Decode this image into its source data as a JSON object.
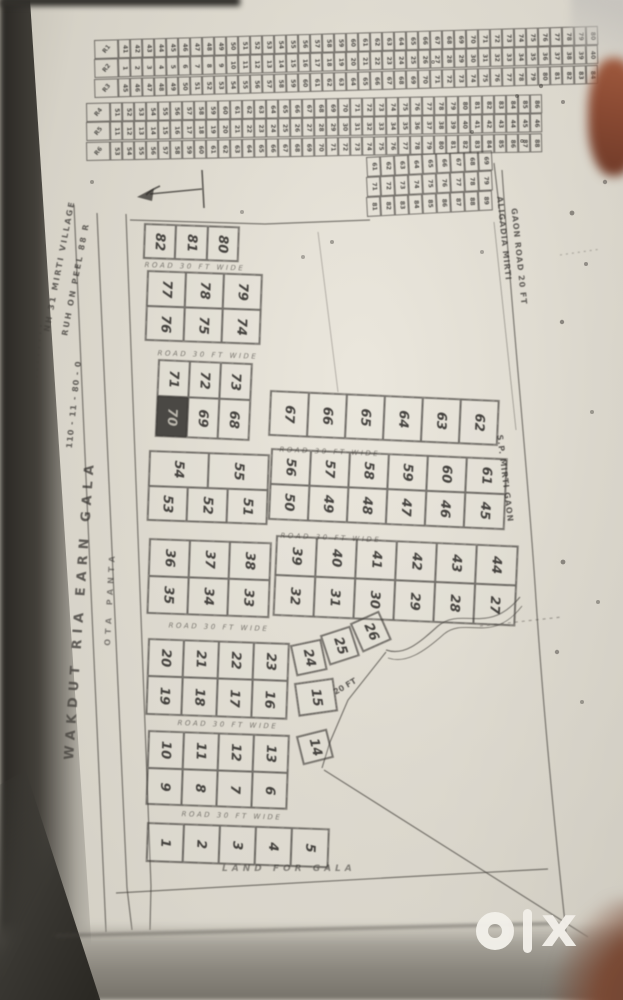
{
  "scene": {
    "description": "Photographed photocopy of a hand-drawn land plot layout / site plan, OLX listing image",
    "watermark": "olx"
  },
  "colors": {
    "paper": "#ddd9ce",
    "ink": "#3a3835",
    "shaded_plot": "#4a4844",
    "photo_edge_shadow": "#292723",
    "finger_blur": "#8a4a33",
    "bottom_band": "#8b877e",
    "watermark": "#f2efe9"
  },
  "road_label": "ROAD 30 FT WIDE",
  "margin_texts": {
    "left_top": [
      "NH 31 MIRTI VILLAGE",
      "RUH ON PEEL 88 R"
    ],
    "left_dim": "110 - 11 - 80 - 0",
    "left_main": "WAKDUT RIA EARN GALA",
    "left_road": "OTA PANTA",
    "right_top": [
      "ALIGADIA MIRTI",
      "GAON ROAD 20 FT"
    ],
    "right_mid": "S.P. MIRTI GAON",
    "curve_note": "20 FT",
    "bottom_note": "LAND FOR GALA"
  },
  "decor": {
    "dots_long": "· · · · · · · · · · · · ·",
    "dots_short": "· · · · · ·"
  },
  "top_strips": {
    "note": "six long strips of tiny plots, two-digit numbers largely illegible in scan",
    "rows": [
      {
        "label": "R1",
        "cells": 40,
        "num_start": 41
      },
      {
        "label": "R2",
        "cells": 40,
        "num_start": 1
      },
      {
        "label": "R3",
        "cells": 40,
        "num_start": 45
      },
      {
        "label": "R4",
        "cells": 36,
        "num_start": 51
      },
      {
        "label": "R5",
        "cells": 36,
        "num_start": 11
      },
      {
        "label": "R6",
        "cells": 36,
        "num_start": 53
      }
    ]
  },
  "small_grid": {
    "note": "small 3-row grid of tiny numbered plots, right of north arrow",
    "rows": [
      {
        "cells": 9,
        "num_start": 61
      },
      {
        "cells": 9,
        "num_start": 71
      },
      {
        "cells": 9,
        "num_start": 81
      }
    ]
  },
  "plot_blocks": [
    {
      "id": "row-82-80",
      "rows": [
        [
          "82",
          "81",
          "80"
        ]
      ]
    },
    {
      "id": "block-74-79",
      "rows": [
        [
          "77",
          "78",
          "79"
        ],
        [
          "76",
          "75",
          "74"
        ]
      ]
    },
    {
      "id": "block-68-73",
      "rows": [
        [
          "71",
          "72",
          "73"
        ],
        [
          "70",
          "69",
          "68"
        ]
      ],
      "shaded": "70"
    },
    {
      "id": "row-62-67",
      "rows": [
        [
          "67",
          "66",
          "65",
          "64",
          "63",
          "62"
        ]
      ]
    },
    {
      "id": "block-51-55",
      "rows": [
        [
          "54",
          "55"
        ],
        [
          "53",
          "52",
          "51"
        ]
      ]
    },
    {
      "id": "block-45-61",
      "rows": [
        [
          "56",
          "57",
          "58",
          "59",
          "60",
          "61"
        ],
        [
          "50",
          "49",
          "48",
          "47",
          "46",
          "45"
        ]
      ]
    },
    {
      "id": "block-33-38",
      "rows": [
        [
          "36",
          "37",
          "38"
        ],
        [
          "35",
          "34",
          "33"
        ]
      ]
    },
    {
      "id": "block-27-44",
      "rows": [
        [
          "39",
          "40",
          "41",
          "42",
          "43",
          "44"
        ],
        [
          "32",
          "31",
          "30",
          "29",
          "28",
          "27"
        ]
      ]
    },
    {
      "id": "block-16-23",
      "rows": [
        [
          "20",
          "21",
          "22",
          "23"
        ],
        [
          "19",
          "18",
          "17",
          "16"
        ]
      ]
    },
    {
      "id": "plot-24",
      "rows": [
        [
          "24"
        ]
      ]
    },
    {
      "id": "plot-25",
      "rows": [
        [
          "25"
        ]
      ]
    },
    {
      "id": "plot-26",
      "rows": [
        [
          "26"
        ]
      ]
    },
    {
      "id": "plot-15",
      "rows": [
        [
          "15"
        ]
      ]
    },
    {
      "id": "block-6-13",
      "rows": [
        [
          "10",
          "11",
          "12",
          "13"
        ],
        [
          "9",
          "8",
          "7",
          "6"
        ]
      ]
    },
    {
      "id": "plot-14",
      "rows": [
        [
          "14"
        ]
      ]
    },
    {
      "id": "row-1-5",
      "rows": [
        [
          "1",
          "2",
          "3",
          "4",
          "5"
        ]
      ]
    }
  ],
  "watermark": {
    "text": "olx"
  }
}
